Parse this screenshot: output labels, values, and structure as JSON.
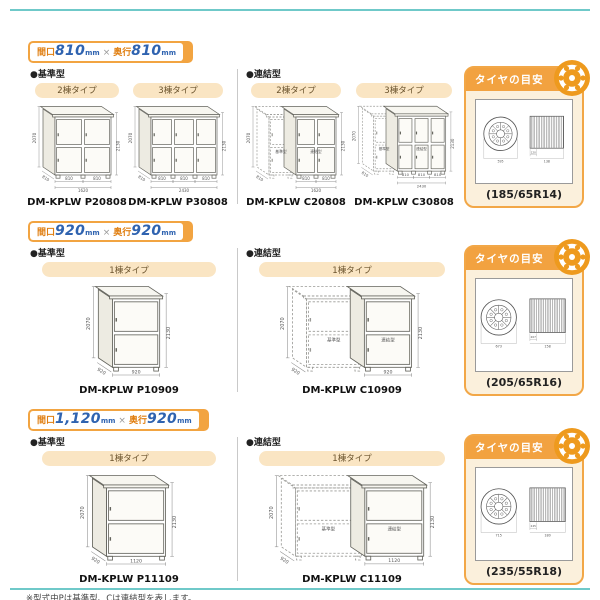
{
  "page": {
    "notes": [
      "※型式中Pは基準型、Cは連結型を表します。",
      "※連結型は単独では使用できません。基準型の右側に連結します。"
    ]
  },
  "colors": {
    "accent_orange": "#F2A441",
    "header_orange": "#F2A240",
    "panel_cream": "#FBF0DC",
    "pill_cream": "#FAE5C3",
    "number_blue": "#2F63B0",
    "kanji_orange": "#E07F12",
    "teal_rule": "#6FC9C9"
  },
  "rows": [
    {
      "badge": {
        "w_label": "間口",
        "w_value": "810",
        "w_unit": "mm",
        "times": "×",
        "d_label": "奥行",
        "d_value": "810",
        "d_unit": "mm"
      },
      "standard": {
        "label": "●基準型",
        "items": [
          {
            "tab": "2棟タイプ",
            "model": "DM-KPLW P20808",
            "shed": {
              "units": 2,
              "unit_w": 28,
              "dashed": 0,
              "unit_dim": "810",
              "total_dim": "1620",
              "depth_dim": "810",
              "h_left": "2070",
              "h_right": "2130"
            }
          },
          {
            "tab": "3棟タイプ",
            "model": "DM-KPLW P30808",
            "shed": {
              "units": 3,
              "unit_w": 22,
              "dashed": 0,
              "unit_dim": "810",
              "total_dim": "2430",
              "depth_dim": "810",
              "h_left": "2070",
              "h_right": "2130"
            }
          }
        ]
      },
      "linked": {
        "label": "●連結型",
        "items": [
          {
            "tab": "2棟タイプ",
            "model": "DM-KPLW C20808",
            "shed": {
              "units": 2,
              "unit_w": 20,
              "dashed": 1,
              "dashed_w": 24,
              "unit_dim": "810",
              "total_dim": "1620",
              "depth_dim": "810",
              "h_left": "2070",
              "h_right": "2130",
              "part_labels": [
                "基準型",
                "連結型"
              ]
            }
          },
          {
            "tab": "3棟タイプ",
            "model": "DM-KPLW C30808",
            "shed": {
              "units": 3,
              "unit_w": 17,
              "dashed": 1,
              "dashed_w": 22,
              "unit_dim": "810",
              "total_dim": "2430",
              "depth_dim": "810",
              "h_left": "2070",
              "h_right": "2130",
              "part_labels": [
                "基準型",
                "連結型"
              ]
            }
          }
        ]
      },
      "tire": {
        "title": "タイヤの目安",
        "size": "(185/65R14)",
        "dia": "595",
        "small": "120",
        "width": "138"
      }
    },
    {
      "badge": {
        "w_label": "間口",
        "w_value": "920",
        "w_unit": "mm",
        "times": "×",
        "d_label": "奥行",
        "d_value": "920",
        "d_unit": "mm"
      },
      "standard": {
        "label": "●基準型",
        "items": [
          {
            "tab": "1棟タイプ",
            "model": "DM-KPLW P10909",
            "shed": {
              "units": 1,
              "unit_w": 40,
              "dashed": 0,
              "unit_dim": "920",
              "depth_dim": "920",
              "h_left": "2070",
              "h_right": "2130"
            }
          }
        ]
      },
      "linked": {
        "label": "●連結型",
        "items": [
          {
            "tab": "1棟タイプ",
            "model": "DM-KPLW C10909",
            "shed": {
              "units": 1,
              "unit_w": 40,
              "dashed": 1,
              "dashed_w": 46,
              "unit_dim": "920",
              "depth_dim": "920",
              "h_left": "2070",
              "h_right": "2130",
              "part_labels": [
                "基準型",
                "連結型"
              ]
            }
          }
        ]
      },
      "tire": {
        "title": "タイヤの目安",
        "size": "(205/65R16)",
        "dia": "673",
        "small": "207",
        "width": "158"
      }
    },
    {
      "badge": {
        "w_label": "間口",
        "w_value": "1,120",
        "w_unit": "mm",
        "times": "×",
        "d_label": "奥行",
        "d_value": "920",
        "d_unit": "mm"
      },
      "standard": {
        "label": "●基準型",
        "items": [
          {
            "tab": "1棟タイプ",
            "model": "DM-KPLW P11109",
            "shed": {
              "units": 1,
              "unit_w": 50,
              "dashed": 0,
              "unit_dim": "1120",
              "depth_dim": "920",
              "h_left": "2070",
              "h_right": "2130"
            }
          }
        ]
      },
      "linked": {
        "label": "●連結型",
        "items": [
          {
            "tab": "1棟タイプ",
            "model": "DM-KPLW C11109",
            "shed": {
              "units": 1,
              "unit_w": 50,
              "dashed": 1,
              "dashed_w": 56,
              "unit_dim": "1120",
              "depth_dim": "920",
              "h_left": "2070",
              "h_right": "2130",
              "part_labels": [
                "基準型",
                "連結型"
              ]
            }
          }
        ]
      },
      "tire": {
        "title": "タイヤの目安",
        "size": "(235/55R18)",
        "dia": "715",
        "small": "245",
        "width": "180"
      }
    }
  ]
}
